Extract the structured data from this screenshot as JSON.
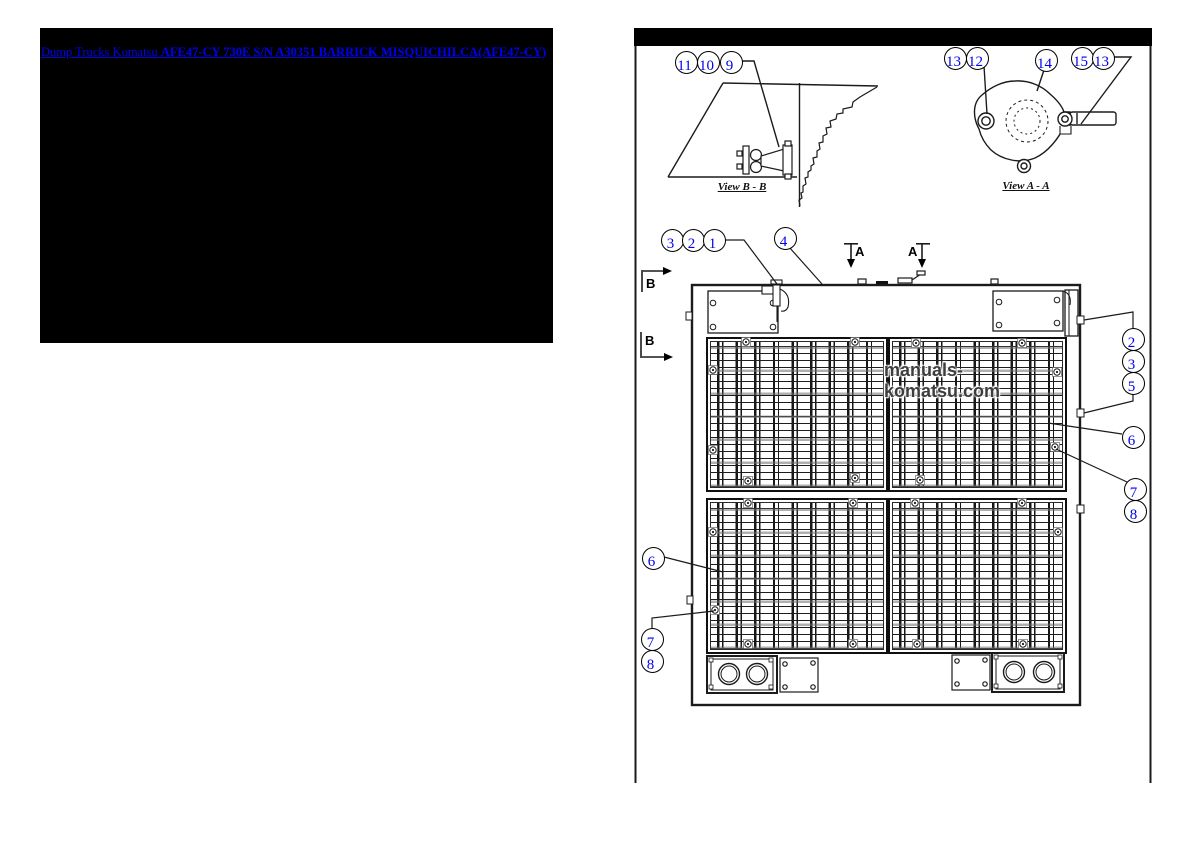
{
  "catalog_link": {
    "prefix": "Dump Trucks Komatsu ",
    "model": "AFE47-CY 730E S/N A30351 BARRICK MISQUICHILCA(AFE47-CY)"
  },
  "diagram": {
    "watermark": "manuals-komatsu.com",
    "view_bb": {
      "label": "View B - B"
    },
    "view_aa": {
      "label": "View A - A"
    },
    "sections": {
      "a": "A",
      "b": "B"
    },
    "callouts": [
      {
        "n": "11"
      },
      {
        "n": "10"
      },
      {
        "n": "9"
      },
      {
        "n": "13"
      },
      {
        "n": "12"
      },
      {
        "n": "14"
      },
      {
        "n": "15"
      },
      {
        "n": "13"
      },
      {
        "n": "3"
      },
      {
        "n": "2"
      },
      {
        "n": "1"
      },
      {
        "n": "4"
      },
      {
        "n": "2"
      },
      {
        "n": "3"
      },
      {
        "n": "5"
      },
      {
        "n": "6"
      },
      {
        "n": "7"
      },
      {
        "n": "8"
      },
      {
        "n": "6"
      },
      {
        "n": "7"
      },
      {
        "n": "8"
      }
    ],
    "colors": {
      "link": "#0000ee",
      "callout_number": "#0000ee",
      "line": "#1b1b1b"
    }
  }
}
